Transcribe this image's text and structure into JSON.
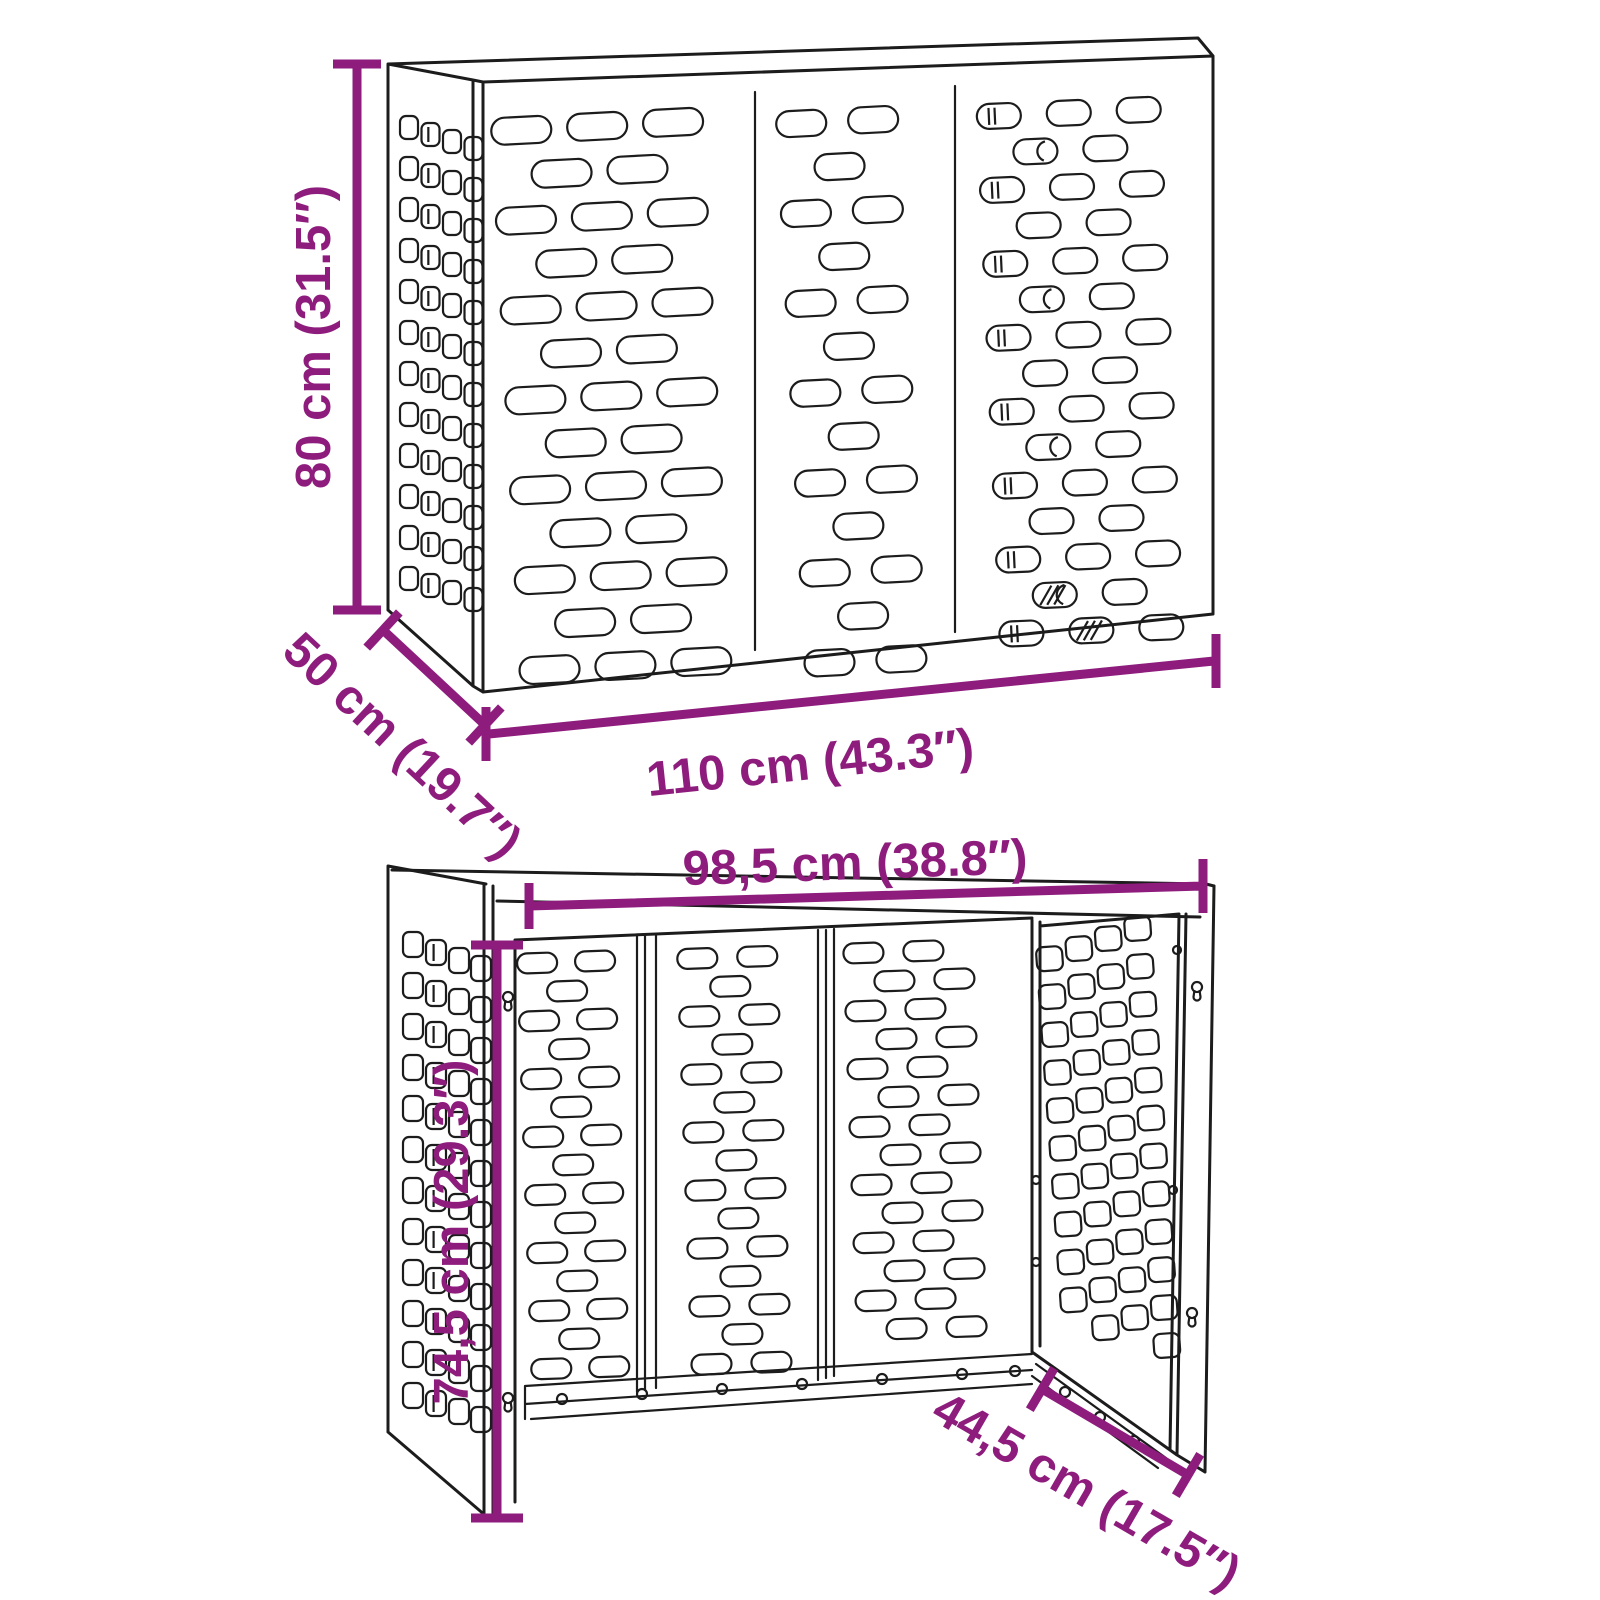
{
  "diagram": {
    "colors": {
      "accent": "#8E1C7D",
      "ink": "#1C1C1C",
      "background": "#FFFFFF"
    },
    "views": {
      "assembled": {
        "dimensions": {
          "height": "80 cm (31.5″)",
          "depth": "50 cm (19.7″)",
          "width": "110 cm (43.3″)"
        }
      },
      "frame": {
        "dimensions": {
          "width": "98,5 cm (38.8″)",
          "height": "74,5 cm (29.3″)",
          "depth": "44,5 cm (17.5″)"
        }
      }
    }
  }
}
